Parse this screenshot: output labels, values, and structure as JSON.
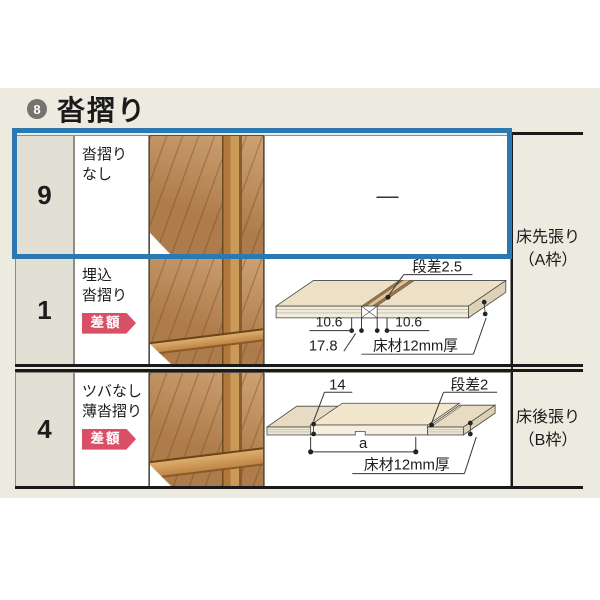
{
  "header": {
    "index_badge": "8",
    "title": "沓摺り"
  },
  "colors": {
    "accent_blue": "#2b79b2",
    "badge_red": "#d94f66",
    "band_beige": "#edeadf"
  },
  "table": {
    "rows": [
      {
        "id": "9",
        "label_lines": [
          "沓摺り",
          "なし"
        ],
        "badge": "",
        "diagram_dash": "—",
        "selected": true
      },
      {
        "id": "1",
        "label_lines": [
          "埋込",
          "沓摺り"
        ],
        "badge": "差額",
        "selected": false
      },
      {
        "id": "4",
        "label_lines": [
          "ツバなし",
          "薄沓摺り"
        ],
        "badge": "差額",
        "selected": false
      }
    ],
    "right_labels": [
      {
        "line1": "床先張り",
        "line2": "（A枠）"
      },
      {
        "line1": "床後張り",
        "line2": "（B枠）"
      }
    ]
  },
  "diagram_embedded": {
    "step": "段差2.5",
    "dim_left": "10.6",
    "dim_right": "10.6",
    "dim_total": "17.8",
    "material": "床材12mm厚"
  },
  "diagram_thin": {
    "dim_left": "14",
    "step": "段差2",
    "span": "a",
    "material": "床材12mm厚"
  }
}
